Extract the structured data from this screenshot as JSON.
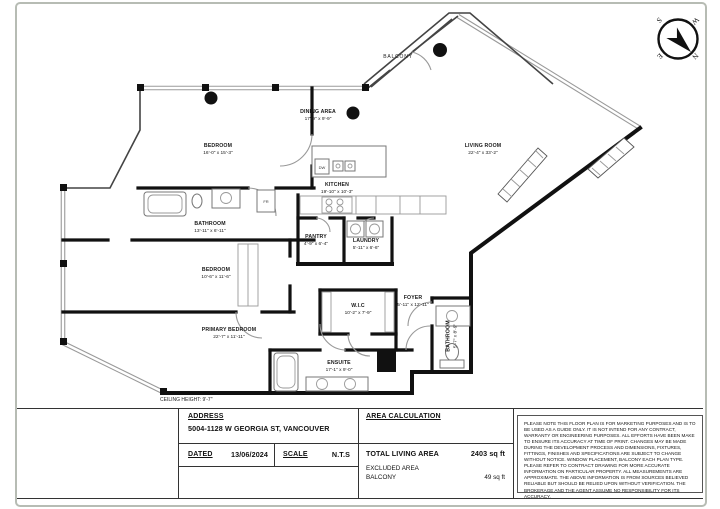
{
  "compass": {
    "n": "N",
    "e": "E",
    "s": "S",
    "w": "W"
  },
  "plan": {
    "balcony_label": "BALCONY",
    "ceiling_note": "CEILING HEIGHT: 9'-7\"",
    "appliances": {
      "dishwasher": "DW",
      "fridge": "FR"
    },
    "rooms": {
      "dining": {
        "name": "DINING AREA",
        "dims": "17'-9\" x 9'-9\""
      },
      "living": {
        "name": "LIVING ROOM",
        "dims": "22'-4\" x 33'-2\""
      },
      "bedroom1": {
        "name": "BEDROOM",
        "dims": "16'-0\" x 15'-3\""
      },
      "bathroom1": {
        "name": "BATHROOM",
        "dims": "13'-11\" x 6'-11\""
      },
      "kitchen": {
        "name": "KITCHEN",
        "dims": "19'-10\" x 10'-3\""
      },
      "pantry": {
        "name": "PANTRY",
        "dims": "4'-9\" x 6'-4\""
      },
      "laundry": {
        "name": "LAUNDRY",
        "dims": "5'-11\" x 6'-6\""
      },
      "bedroom2": {
        "name": "BEDROOM",
        "dims": "10'-6\" x 11'-6\""
      },
      "wic": {
        "name": "W.I.C",
        "dims": "10'-2\" x 7'-9\""
      },
      "foyer": {
        "name": "FOYER",
        "dims": "5'-11\" x 12'-11\""
      },
      "primary": {
        "name": "PRIMARY BEDROOM",
        "dims": "22'-7\" x 11'-11\""
      },
      "ensuite": {
        "name": "ENSUITE",
        "dims": "17'-1\" x 9'-0\""
      },
      "bathroom2": {
        "name": "BATHROOM",
        "dims": "5'-7\" x 8'-9\""
      }
    }
  },
  "title_block": {
    "address_label": "ADDRESS",
    "address_value": "5004-1128 W GEORGIA ST, VANCOUVER",
    "dated_label": "DATED",
    "dated_value": "13/06/2024",
    "scale_label": "SCALE",
    "scale_value": "N.T.S",
    "area_title": "AREA CALCULATION",
    "total_label": "TOTAL LIVING AREA",
    "total_value": "2403 sq ft",
    "excluded_label": "EXCLUDED AREA",
    "excluded_item": "BALCONY",
    "excluded_value": "49 sq ft",
    "disclaimer": "PLEASE NOTE THIS FLOOR PLAN IS FOR MARKETING PURPOSES AND IS TO BE USED AS A GUIDE ONLY. IT IS NOT INTEND FOR ANY CONTRACT, WARRANTY OR ENGINEERING PURPOSES. ALL EFFORTS HAVE BEEN MAKE TO ENSURE ITS ACCURACY AT TIME OF PRINT. CHANGES MAY BE MADE DURING THE DEVELOPMENT PROCESS AND DIMENSIONS, FIXTURES, FITTINGS, FINISHES AND SPECIFICATIONS ARE SUBJECT TO CHANGE WITHOUT NOTICE. WINDOW PLACEMENT, BALCONY EACH PLAN TYPE. PLEASE REFER TO CONTRACT DRAWING FOR MORE ACCURATE INFORMATION ON PARTICULAR PROPERTY. ALL MEASUREMENTS ARE APPROXIMATE. THE ABOVE INFORMATION IS FROM SOURCES BELIEVED RELIABLE BUT SHOULD BE RELIED UPON WITHOUT VERIFICATION. THE BROKERAGE AND THE AGENT ASSUME NO RESPONSIBILITY FOR ITS ACCURACY."
  }
}
